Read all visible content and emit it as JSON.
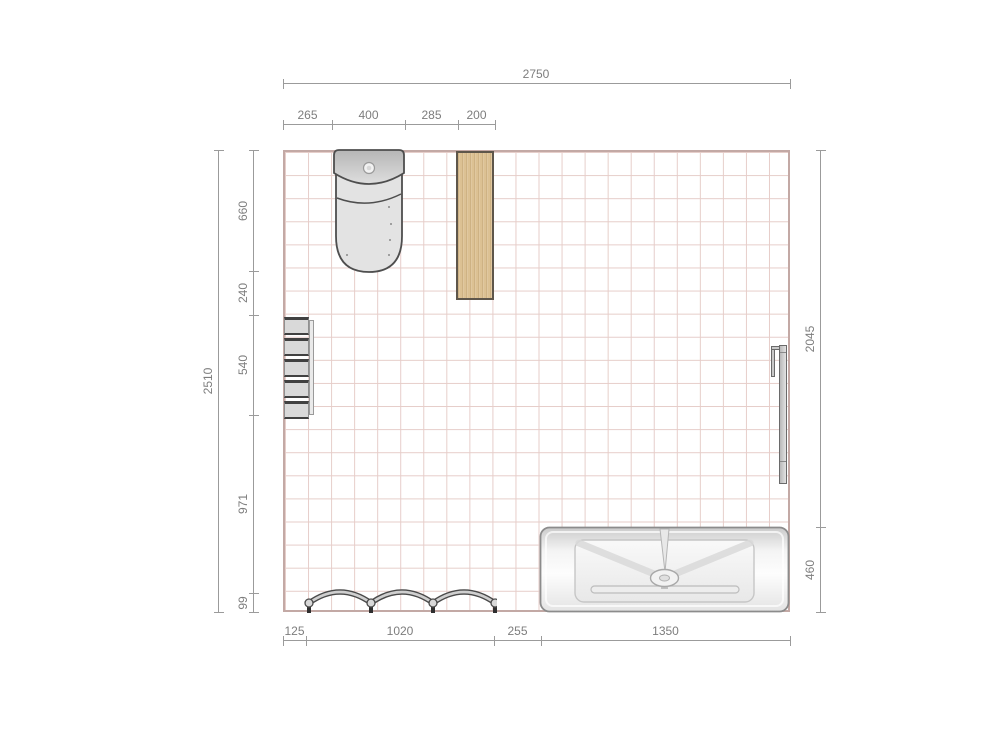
{
  "dims": {
    "top_total": "2750",
    "top_segments": [
      "265",
      "400",
      "285",
      "200"
    ],
    "left_total": "2510",
    "left_segments": [
      "660",
      "240",
      "540",
      "971",
      "99"
    ],
    "right_segments": [
      "2045",
      "460"
    ],
    "bottom_segments": [
      "125",
      "1020",
      "255",
      "1350"
    ]
  },
  "objects": {
    "toilet": "toilet",
    "wood_panel": "tall-wooden-panel",
    "shelf": "wall-shelf-column",
    "wallbar": "towel-radiator-bar",
    "bathtub": "bathtub",
    "towel_bows": "triple-bow-towel-holder"
  },
  "colors": {
    "grid_line": "#e6cdc9",
    "room_border": "#c3a9a5",
    "dim_line": "#9b9b9b",
    "dim_text": "#7d7d7d",
    "wood_fill": "#dcc193",
    "wood_border": "#5e564b",
    "object_outline": "#4e4e4e",
    "object_fill": "#e2e2e2"
  }
}
